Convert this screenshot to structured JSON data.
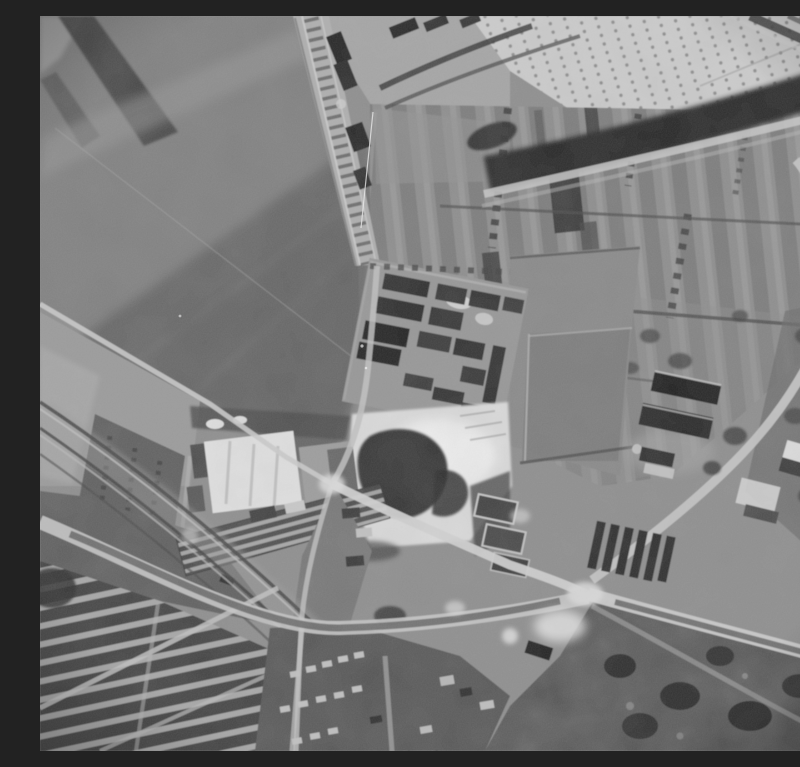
{
  "image": {
    "kind": "black-and-white vertical aerial reconnaissance photograph",
    "alt": "Monochrome aerial photograph: large ploughed fields upper left, a railway with sidings and wagons running diagonally from the top, an orchard field and dark tree belt upper right, striped allotment parcels in the centre right, a rectangular dark building complex in the centre, a bright sand pit with dark spoil below it, a factory with a bright roof on the left, farm barns on the right, converging roads with a large junction lower right, railway lines and terraced housing lower left, and dark woodland in the bottom right corner.",
    "width_px": 800,
    "height_px": 735
  },
  "palette": {
    "highlight_white": "#e8e8e8",
    "light_gray": "#c9c9c9",
    "mid_gray": "#8b8b8b",
    "field_dark": "#4e4e4e",
    "shadow_black": "#262626"
  },
  "regions": [
    {
      "id": "field-top-left",
      "label": "large ploughed fields with diagonal tonal bands"
    },
    {
      "id": "railway-sidings",
      "label": "railway with sidings and dark wagons"
    },
    {
      "id": "orchard-field",
      "label": "pale stubble/orchard field with rows of dots"
    },
    {
      "id": "tree-belt",
      "label": "dark tree-lined belt with parallel footpath"
    },
    {
      "id": "allotment-strips",
      "label": "narrow striped cultivation parcels with tree rows"
    },
    {
      "id": "building-complex",
      "label": "rectangular complex of dark-roofed blocks"
    },
    {
      "id": "sand-pit",
      "label": "bright excavation with irregular dark spoil heap"
    },
    {
      "id": "factory",
      "label": "factory with bright roof and long ridged shed"
    },
    {
      "id": "farm-barns",
      "label": "dark barns and outbuildings on the right"
    },
    {
      "id": "road-network",
      "label": "roads converging on a large junction"
    },
    {
      "id": "railway-lines-bottom",
      "label": "multiple railway lines crossing the lower left"
    },
    {
      "id": "terraced-housing",
      "label": "rows of terraced houses and streets"
    },
    {
      "id": "woodland",
      "label": "dark mottled woodland, bottom right"
    },
    {
      "id": "film-artifacts",
      "label": "film grain, scratches and vignette"
    }
  ]
}
